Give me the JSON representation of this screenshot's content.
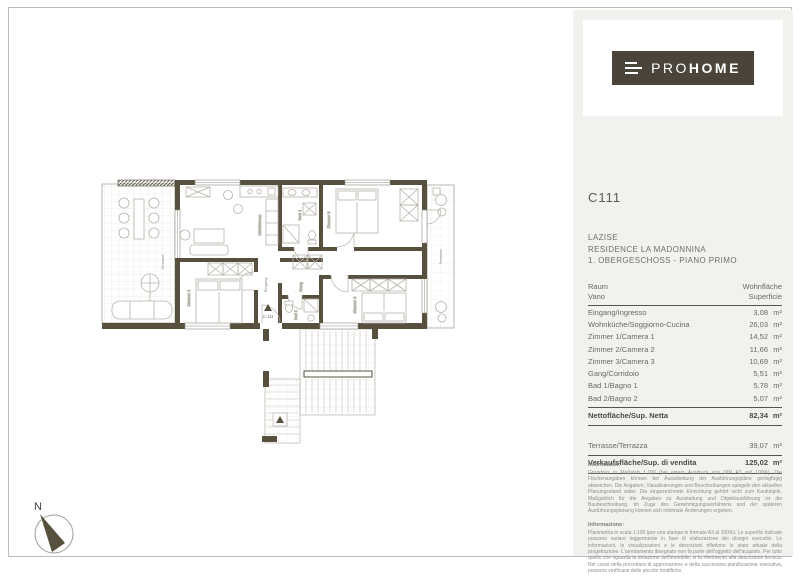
{
  "colors": {
    "wall": "#57503e",
    "brand_logo_bg": "#4a443b",
    "sidebar_bg": "#f2f1ee",
    "furniture_line": "#b6b2a8"
  },
  "plan": {
    "compass_label": "N",
    "unit_marker": "C-111",
    "rooms": {
      "terrace_left": "Terrasse",
      "terrace_right": "Terrasse",
      "living": "Kü/Wohnen",
      "bad1": "Bad 1",
      "zimmer3": "Zimmer 3",
      "gang": "Gang",
      "eingang": "Eingang",
      "bad2": "Bad 2",
      "zimmer1": "Zimmer 1",
      "zimmer2": "Zimmer 2"
    }
  },
  "sidebar": {
    "logo": {
      "text_light": "PRO",
      "text_bold": "HOME"
    },
    "unit_code": "C111",
    "location": {
      "line1": "LAZISE",
      "line2": "RESIDENCE LA MADONNINA",
      "line3": "1. OBERGESCHOSS - PIANO PRIMO"
    },
    "table": {
      "header": {
        "col1_line1": "Raum",
        "col1_line2": "Vano",
        "col2_line1": "Wohnfläche",
        "col2_line2": "Superficie"
      },
      "unit": "m²",
      "rows": [
        {
          "name": "Eingang/Ingresso",
          "value": "3,08"
        },
        {
          "name": "Wohnküche/Soggiorno-Cucina",
          "value": "26,03"
        },
        {
          "name": "Zimmer 1/Camera 1",
          "value": "14,52"
        },
        {
          "name": "Zimmer 2/Camera 2",
          "value": "11,66"
        },
        {
          "name": "Zimmer 3/Camera 3",
          "value": "10,69"
        },
        {
          "name": "Gang/Corridoio",
          "value": "5,51"
        },
        {
          "name": "Bad 1/Bagno 1",
          "value": "5,78"
        },
        {
          "name": "Bad 2/Bagno 2",
          "value": "5,07"
        }
      ],
      "summary": {
        "net": {
          "name": "Nettofläche/Sup. Netta",
          "value": "82,34"
        },
        "terrace": {
          "name": "Terrasse/Terrazza",
          "value": "39,07"
        },
        "sale": {
          "name": "Verkaufsfläche/Sup. di vendita",
          "value": "125,02"
        }
      }
    },
    "notes": {
      "de_title": "Information:",
      "de_body": "Grundriss in Maßstab 1:100 (bei einem Ausdruck von DIN A3 auf 100%). Die Flächenangaben können bei Ausarbeitung der Ausführungspläne geringfügig abweichen. Die Angaben, Visualisierungen und Beschreibungen spiegeln den aktuellen Planungsstand wider. Die eingezeichnete Einrichtung gehört nicht zum Kaufobjekt. Maßgeblich für die Angaben zu Ausstattung und Objektausführung ist die Baubeschreibung. Im Zuge des Genehmigungsverfahrens und der späteren Ausführungsplanung können sich minimale Änderungen ergeben.",
      "it_title": "Informazione:",
      "it_body": "Planimetria in scala 1:100 (per una stampa in formato A3 al 100%). Le superfici indicate possono variare leggermente in fase di elaborazione dei disegni esecutivi. Le informazioni, le visualizzazioni e le descrizioni riflettono lo stato attuale della progettazione. L'arredamento disegnato non fa parte dell'oggetto dell'acquisto. Per tutto quello che riguarda la dotazione dell'immobile, si fa riferimento alla descrizione tecnica. Nel corso della procedura di approvazione e della successiva pianificazione esecutiva, possono verificarsi delle piccole modifiche."
    }
  }
}
